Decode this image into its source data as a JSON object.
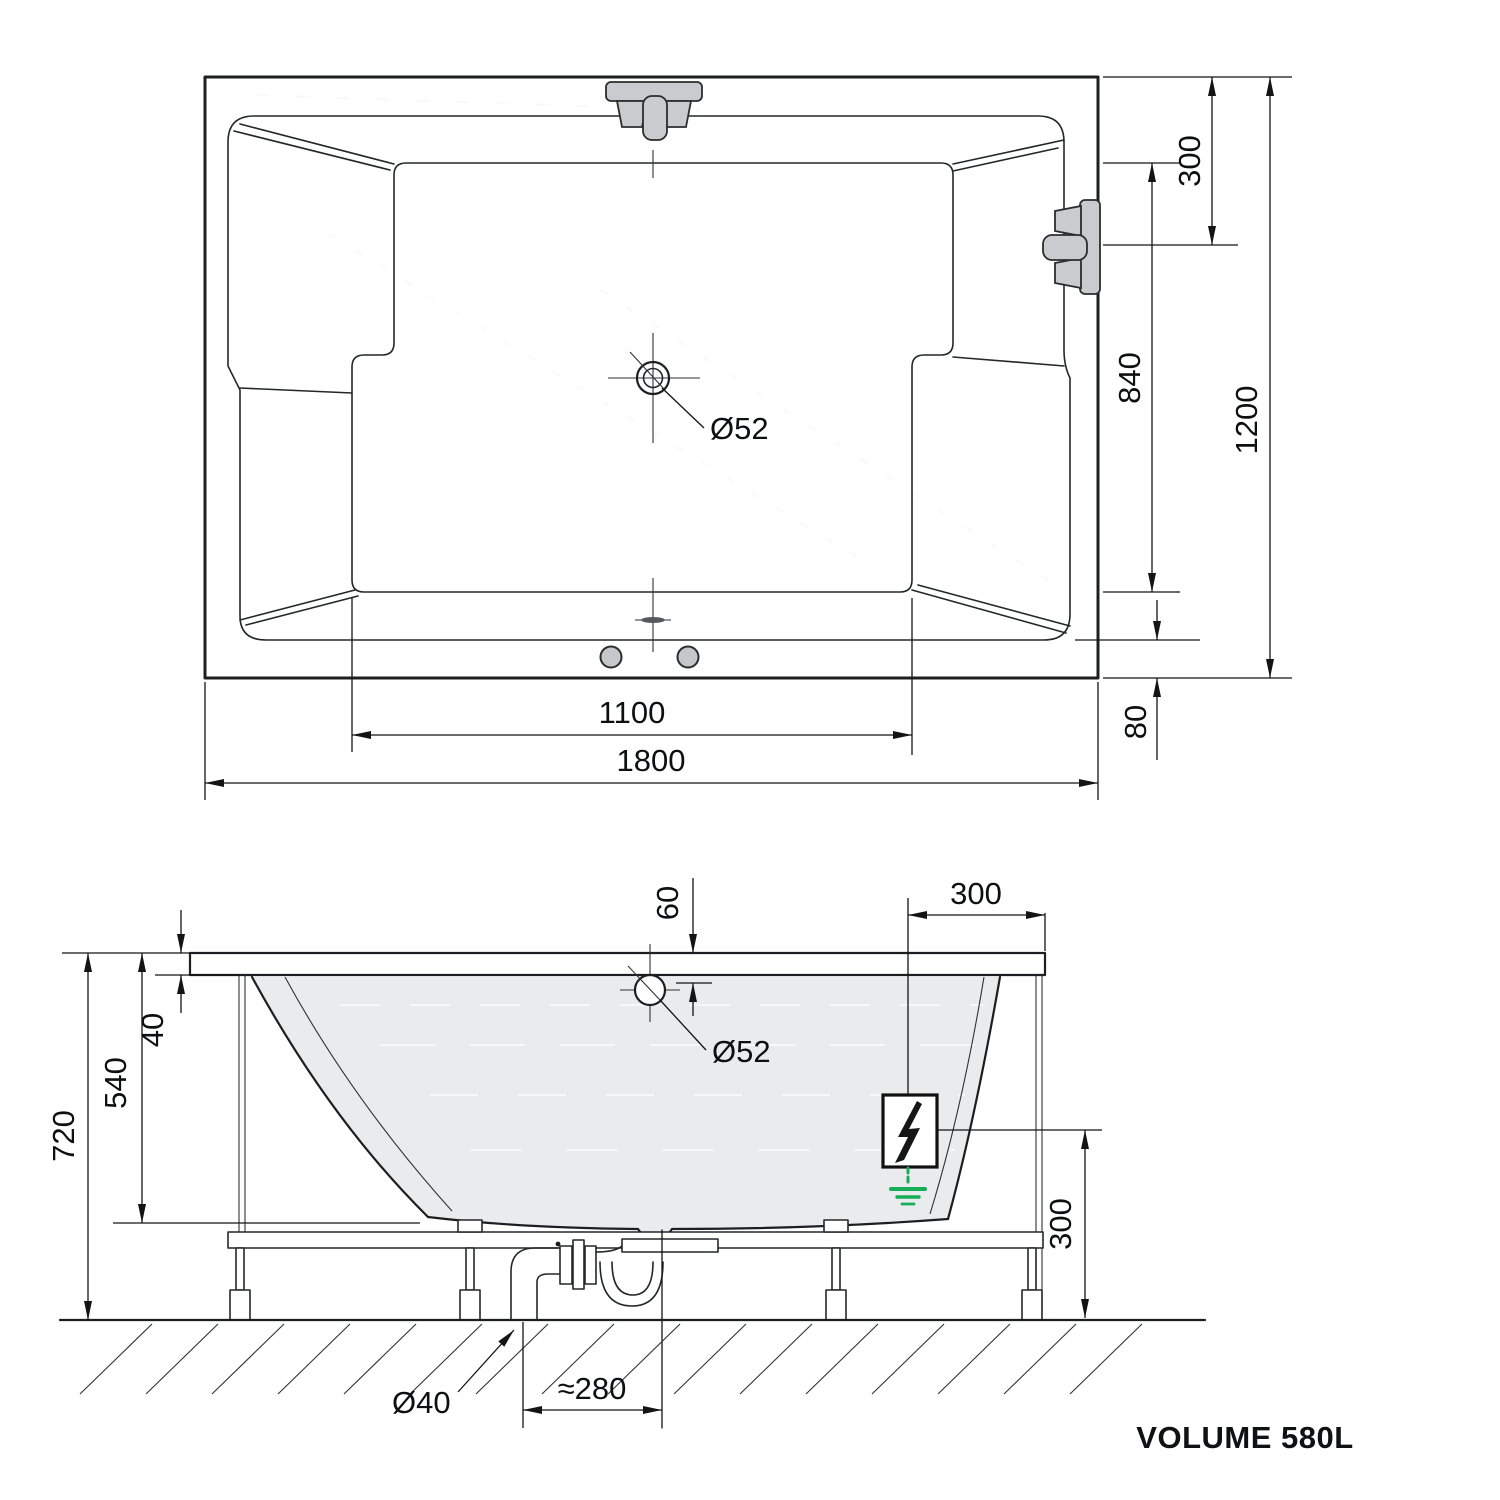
{
  "plan": {
    "dim_overall_length": "1800",
    "dim_floor_length": "1100",
    "dim_overall_width": "1200",
    "dim_faucet_offset": "300",
    "dim_floor_width": "840",
    "dim_rim_overhang": "80",
    "drain_label": "Ø52"
  },
  "side": {
    "dim_total_height": "720",
    "dim_basin_depth": "540",
    "dim_rim_thickness": "40",
    "dim_drain_offset": "60",
    "dim_deck_width": "300",
    "dim_frame_height": "300",
    "drain_label": "Ø52",
    "pipe_label": "Ø40",
    "dim_trap_offset": "≈280"
  },
  "footer": {
    "volume_label": "VOLUME 580L"
  }
}
